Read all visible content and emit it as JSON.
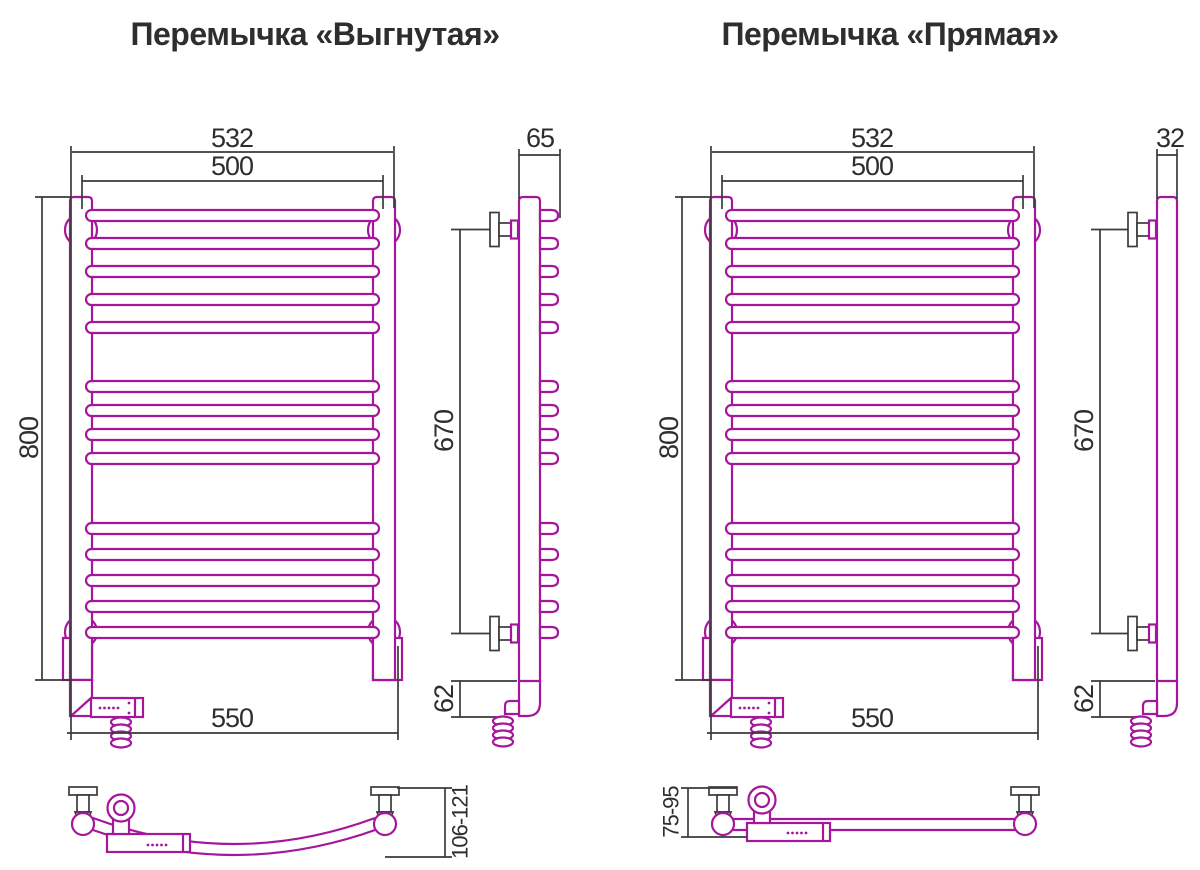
{
  "colors": {
    "drawing_outline": "#a5179a",
    "dimension_lines": "#3a3a3a",
    "label_text": "#2e2e2e",
    "background": "#ffffff"
  },
  "left_drawing": {
    "title": "Перемычка «Выгнутая»",
    "front": {
      "width_outer_mm": "532",
      "width_inner_mm": "500",
      "height_mm": "800",
      "bottom_width_mm": "550"
    },
    "side": {
      "depth_mm": "65",
      "bracket_span_mm": "670",
      "bottom_offset_mm": "62"
    },
    "bottom": {
      "wall_distance_mm": "106-121"
    }
  },
  "right_drawing": {
    "title": "Перемычка «Прямая»",
    "front": {
      "width_outer_mm": "532",
      "width_inner_mm": "500",
      "height_mm": "800",
      "bottom_width_mm": "550"
    },
    "side": {
      "depth_mm": "32",
      "bracket_span_mm": "670",
      "bottom_offset_mm": "62"
    },
    "bottom": {
      "wall_distance_mm": "75-95"
    }
  }
}
